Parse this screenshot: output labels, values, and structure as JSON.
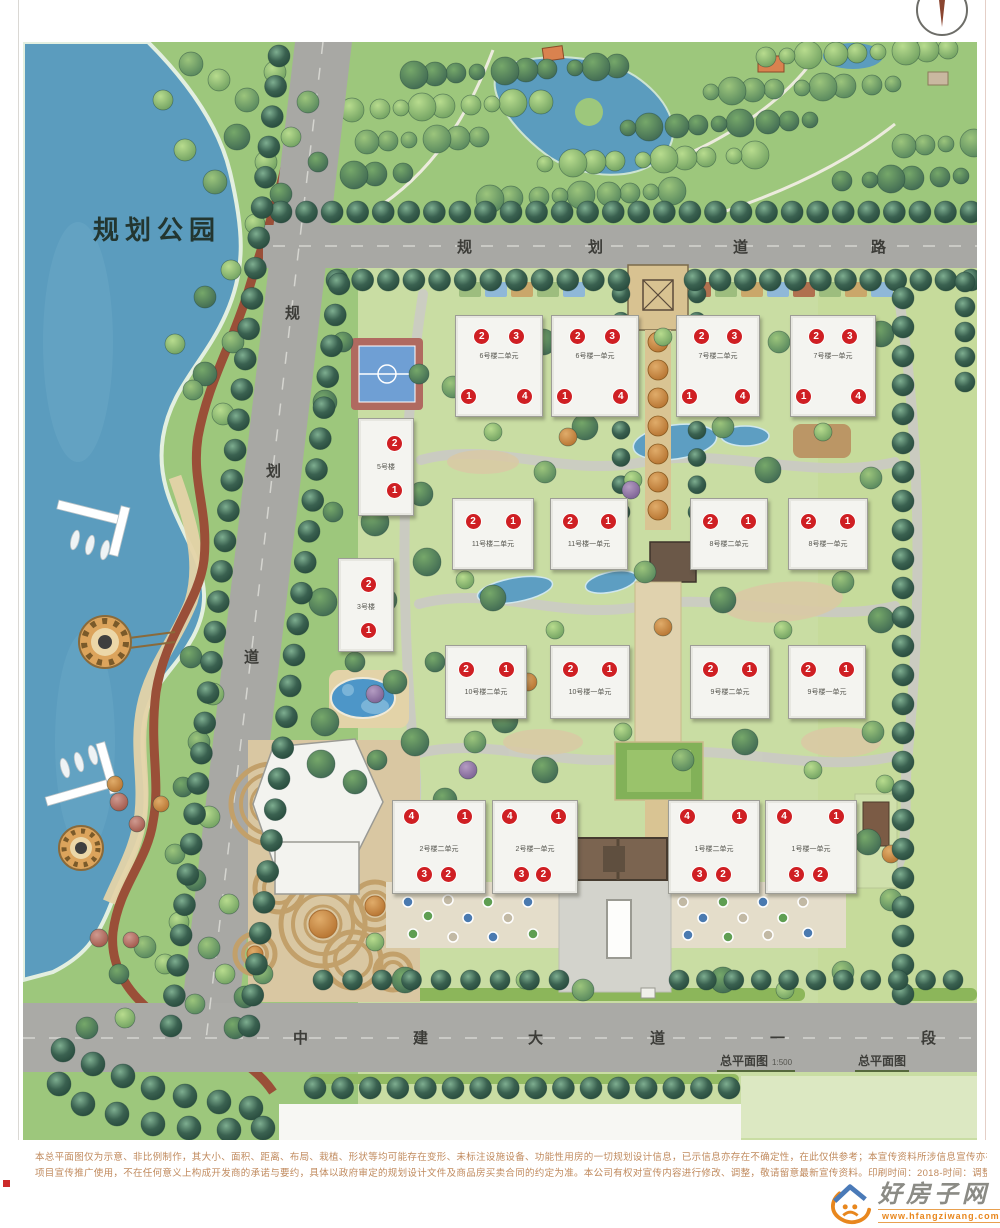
{
  "labels": {
    "park": "规划公园"
  },
  "roads": {
    "top": [
      "规",
      "划",
      "道",
      "路"
    ],
    "left": [
      "规",
      "划",
      "道"
    ],
    "bottom": [
      "中",
      "建",
      "大",
      "道",
      "一",
      "段"
    ]
  },
  "titles": {
    "plan": "总平面图",
    "scale": "1:500",
    "plan2": "总平面图"
  },
  "disclaimer": {
    "line1": "本总平面图仅为示意、非比例制作，其大小、面积、距离、布局、栽植、形状等均可能存在变形、未标注设施设备、功能性用房的一切规划设计信息，已示信息亦存在不确定性，在此仅供参考；本宣传资料所涉信息宣传亦存不确定性，在此仅供参考；本宣传资料",
    "line2": "项目宣传推广使用，不在任何意义上构成开发商的承诺与要约，具体以政府审定的规划设计文件及商品房买卖合同的约定为准。本公司有权对宣传内容进行修改、调整，敬请留意最新宣传资料。印刷时间：2018-时间：调整，敬请留意最新宣传资料、印刷"
  },
  "logo": {
    "name": "好房子网",
    "url": "www.hfangziwang.com"
  },
  "colors": {
    "badge_red": "#cf1f23",
    "lake_blue": "#5b9cbe",
    "park_green": "#9dc77c",
    "site_green": "#c9dda3",
    "road_gray": "#a8a8a4",
    "path_red": "#9a4f38",
    "canopy_brown": "#7b6450",
    "logo_orange": "#e8871e"
  },
  "buildings": [
    {
      "id": "6-2",
      "label": "6号楼二单元",
      "x": 432,
      "y": 273,
      "w": 86,
      "h": 100,
      "label_fy": 0.4,
      "badges": [
        [
          "2",
          0.3,
          0.2
        ],
        [
          "3",
          0.7,
          0.2
        ],
        [
          "1",
          0.15,
          0.8
        ],
        [
          "4",
          0.8,
          0.8
        ]
      ]
    },
    {
      "id": "6-1",
      "label": "6号楼一单元",
      "x": 528,
      "y": 273,
      "w": 86,
      "h": 100,
      "label_fy": 0.4,
      "badges": [
        [
          "2",
          0.3,
          0.2
        ],
        [
          "3",
          0.7,
          0.2
        ],
        [
          "1",
          0.15,
          0.8
        ],
        [
          "4",
          0.8,
          0.8
        ]
      ]
    },
    {
      "id": "7-2",
      "label": "7号楼二单元",
      "x": 653,
      "y": 273,
      "w": 82,
      "h": 100,
      "label_fy": 0.4,
      "badges": [
        [
          "2",
          0.3,
          0.2
        ],
        [
          "3",
          0.7,
          0.2
        ],
        [
          "1",
          0.15,
          0.8
        ],
        [
          "4",
          0.8,
          0.8
        ]
      ]
    },
    {
      "id": "7-1",
      "label": "7号楼一单元",
      "x": 767,
      "y": 273,
      "w": 84,
      "h": 100,
      "label_fy": 0.4,
      "badges": [
        [
          "2",
          0.3,
          0.2
        ],
        [
          "3",
          0.7,
          0.2
        ],
        [
          "1",
          0.15,
          0.8
        ],
        [
          "4",
          0.8,
          0.8
        ]
      ]
    },
    {
      "id": "11-2",
      "label": "11号楼二单元",
      "x": 429,
      "y": 456,
      "w": 80,
      "h": 70,
      "label_fy": 0.64,
      "badges": [
        [
          "2",
          0.25,
          0.32
        ],
        [
          "1",
          0.75,
          0.32
        ]
      ]
    },
    {
      "id": "11-1",
      "label": "11号楼一单元",
      "x": 527,
      "y": 456,
      "w": 76,
      "h": 70,
      "label_fy": 0.64,
      "badges": [
        [
          "2",
          0.25,
          0.32
        ],
        [
          "1",
          0.75,
          0.32
        ]
      ]
    },
    {
      "id": "8-2",
      "label": "8号楼二单元",
      "x": 667,
      "y": 456,
      "w": 76,
      "h": 70,
      "label_fy": 0.64,
      "badges": [
        [
          "2",
          0.25,
          0.32
        ],
        [
          "1",
          0.75,
          0.32
        ]
      ]
    },
    {
      "id": "8-1",
      "label": "8号楼一单元",
      "x": 765,
      "y": 456,
      "w": 78,
      "h": 70,
      "label_fy": 0.64,
      "badges": [
        [
          "2",
          0.25,
          0.32
        ],
        [
          "1",
          0.75,
          0.32
        ]
      ]
    },
    {
      "id": "10-2",
      "label": "10号楼二单元",
      "x": 422,
      "y": 603,
      "w": 80,
      "h": 72,
      "label_fy": 0.64,
      "badges": [
        [
          "2",
          0.25,
          0.32
        ],
        [
          "1",
          0.75,
          0.32
        ]
      ]
    },
    {
      "id": "10-1",
      "label": "10号楼一单元",
      "x": 527,
      "y": 603,
      "w": 78,
      "h": 72,
      "label_fy": 0.64,
      "badges": [
        [
          "2",
          0.25,
          0.32
        ],
        [
          "1",
          0.75,
          0.32
        ]
      ]
    },
    {
      "id": "9-2",
      "label": "9号楼二单元",
      "x": 667,
      "y": 603,
      "w": 78,
      "h": 72,
      "label_fy": 0.64,
      "badges": [
        [
          "2",
          0.25,
          0.32
        ],
        [
          "1",
          0.75,
          0.32
        ]
      ]
    },
    {
      "id": "9-1",
      "label": "9号楼一单元",
      "x": 765,
      "y": 603,
      "w": 76,
      "h": 72,
      "label_fy": 0.64,
      "badges": [
        [
          "2",
          0.25,
          0.32
        ],
        [
          "1",
          0.75,
          0.32
        ]
      ]
    },
    {
      "id": "2-2",
      "label": "2号楼二单元",
      "x": 369,
      "y": 758,
      "w": 92,
      "h": 92,
      "label_fy": 0.52,
      "badges": [
        [
          "4",
          0.2,
          0.17
        ],
        [
          "1",
          0.78,
          0.17
        ],
        [
          "3",
          0.34,
          0.8
        ],
        [
          "2",
          0.6,
          0.8
        ]
      ]
    },
    {
      "id": "2-1",
      "label": "2号楼一单元",
      "x": 469,
      "y": 758,
      "w": 84,
      "h": 92,
      "label_fy": 0.52,
      "badges": [
        [
          "4",
          0.2,
          0.17
        ],
        [
          "1",
          0.78,
          0.17
        ],
        [
          "3",
          0.34,
          0.8
        ],
        [
          "2",
          0.6,
          0.8
        ]
      ]
    },
    {
      "id": "1-2",
      "label": "1号楼二单元",
      "x": 645,
      "y": 758,
      "w": 90,
      "h": 92,
      "label_fy": 0.52,
      "badges": [
        [
          "4",
          0.2,
          0.17
        ],
        [
          "1",
          0.78,
          0.17
        ],
        [
          "3",
          0.34,
          0.8
        ],
        [
          "2",
          0.6,
          0.8
        ]
      ]
    },
    {
      "id": "1-1",
      "label": "1号楼一单元",
      "x": 742,
      "y": 758,
      "w": 90,
      "h": 92,
      "label_fy": 0.52,
      "badges": [
        [
          "4",
          0.2,
          0.17
        ],
        [
          "1",
          0.78,
          0.17
        ],
        [
          "3",
          0.34,
          0.8
        ],
        [
          "2",
          0.6,
          0.8
        ]
      ]
    },
    {
      "id": "5",
      "label": "5号楼",
      "x": 335,
      "y": 376,
      "w": 54,
      "h": 96,
      "label_fy": 0.5,
      "badges": [
        [
          "2",
          0.66,
          0.26
        ],
        [
          "1",
          0.66,
          0.74
        ]
      ]
    },
    {
      "id": "3",
      "label": "3号楼",
      "x": 315,
      "y": 516,
      "w": 54,
      "h": 92,
      "label_fy": 0.52,
      "badges": [
        [
          "2",
          0.55,
          0.28
        ],
        [
          "1",
          0.55,
          0.78
        ]
      ]
    }
  ]
}
